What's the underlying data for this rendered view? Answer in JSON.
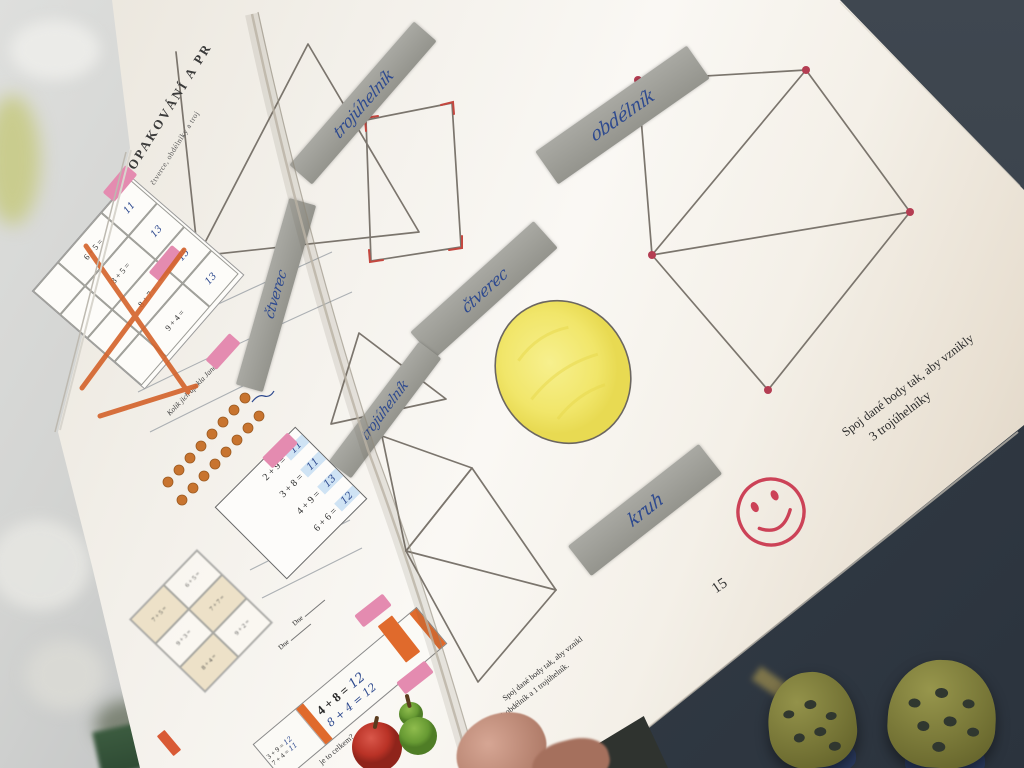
{
  "right_page": {
    "heading": "OPAKOVÁNÍ A PR",
    "subheading": "čtverce, obdélníky a troj",
    "shape_labels": [
      {
        "text": "trojúhelník"
      },
      {
        "text": "obdélník"
      },
      {
        "text": "čtverec"
      },
      {
        "text": "čtverec"
      },
      {
        "text": "trojúhelník"
      },
      {
        "text": "kruh"
      }
    ],
    "exercise_caption": {
      "line1": "Spoj dané body tak, aby vznikly",
      "line2": "3 trojúhelníky"
    },
    "exercise_caption_small": {
      "line1": "Spoj dané body tak, aby vznikl",
      "line2": "1 obdélník a 1 trojúhelník."
    },
    "page_number": "15"
  },
  "left_page": {
    "question": "Kolik jich upekla Jana ?",
    "table_equations": [
      {
        "problem": "6 + 5 =",
        "answer": "11"
      },
      {
        "problem": "8 + 5 =",
        "answer": "13"
      },
      {
        "problem": "8 + 7 =",
        "answer": "15"
      },
      {
        "problem": "9 + 4 =",
        "answer": "13"
      }
    ],
    "practice_box": [
      {
        "problem": "2 + 9 =",
        "answer": "11"
      },
      {
        "problem": "3 + 8 =",
        "answer": "11"
      },
      {
        "problem": "4 + 9 =",
        "answer": "13"
      },
      {
        "problem": "6 + 6 =",
        "answer": "12"
      }
    ],
    "faded_equations": [
      "7 + 5 =",
      "6 + 5 =",
      "9 + 3 =",
      "7 + 7 =",
      "8 + 4 =",
      "9 + 2 ="
    ],
    "strip_equations": [
      {
        "problem": "3 + 9 =",
        "answer": "12"
      },
      {
        "problem": "7 + 4 =",
        "answer": "11"
      }
    ],
    "big_equation": {
      "problem": "4 + 8 =",
      "answer": "12",
      "handwritten": "8 + 4 = 12"
    },
    "total_question": "je to celkem?",
    "date_label": "Dne"
  },
  "colors": {
    "handwriting_blue": "#2e4a8f",
    "label_gray": "#a0a099",
    "accent_pink": "#e48bb0",
    "accent_orange": "#e06a2c",
    "stamp_red": "#cc4257",
    "circle_yellow": "#f1e66a",
    "pencil_gray": "#7b756d",
    "vertex_red": "#b43d52"
  }
}
